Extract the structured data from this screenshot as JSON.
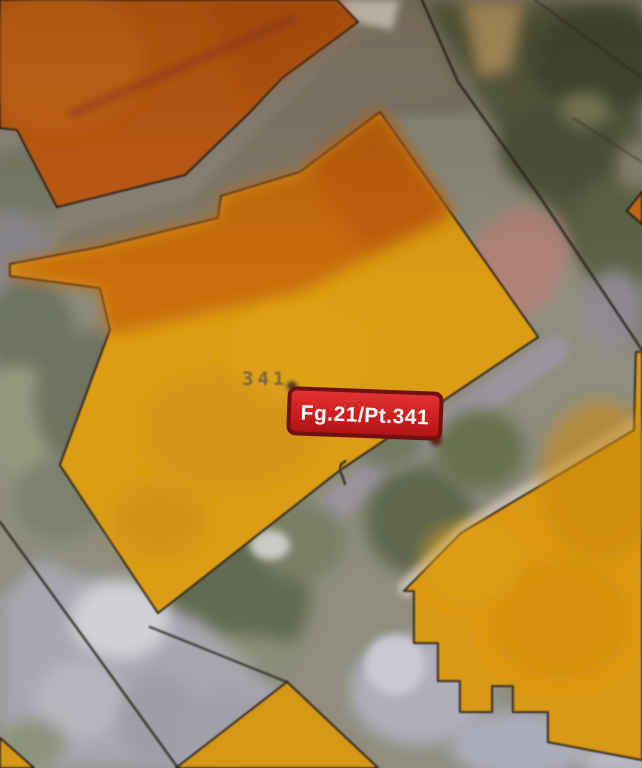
{
  "map": {
    "type": "cadastral-parcel-viewer",
    "parcel_number_label": "341",
    "badge_label": "Fg.21/Pt.341",
    "colors": {
      "parcel_dark_orange": "#c45f12",
      "parcel_gold": "#dfa113",
      "parcel_gold_2": "#dc9b12",
      "parcel_diamond": "#d89a16",
      "parcel_wedge": "#cf6a14",
      "badge_fill": "#cf1f1f",
      "badge_border": "#701010",
      "badge_text": "#ffffff",
      "boundary_line": "#2b251e",
      "parcel_number_color": "#70604b"
    }
  }
}
